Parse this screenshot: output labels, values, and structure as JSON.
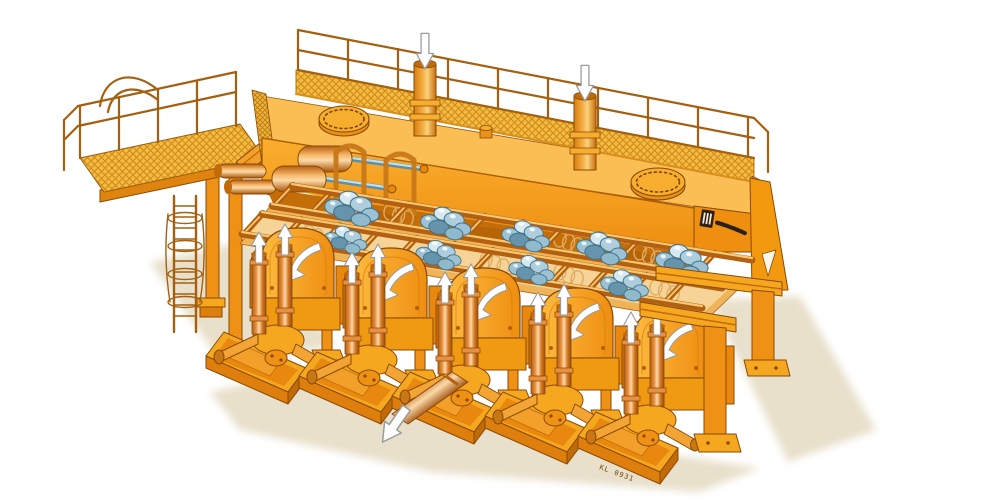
{
  "document": {
    "kind": "technical-illustration",
    "subject": "Isometric airbrush cutaway of an orange industrial machine: tank deck with grated walkway and railings, access platform with caged ladder, reciprocating grate frames carrying blue lump material, and five eccentric drive units on skid bases",
    "background": "#ffffff"
  },
  "texts": {
    "drawing_number": "KL 0931"
  },
  "brand_plate": {
    "legible": false,
    "style": "small dark emblem with slanted italic wordmark on right end panel"
  },
  "palette": {
    "orange_base": "#F49C16",
    "orange_light": "#FBBE55",
    "orange_pale": "#FDD98E",
    "orange_dark": "#DE7E0C",
    "orange_deep": "#C06A08",
    "outline_brown": "#8A4A05",
    "grating_yellow": "#F3BC3F",
    "grating_hatch": "#CE8A1E",
    "railing_brown": "#A4600F",
    "copper_light": "#FCD9A8",
    "copper_mid": "#E89040",
    "copper_dark": "#B55E14",
    "lump_blue_light": "#D7E8F0",
    "lump_blue_mid": "#9CC2D4",
    "lump_blue_dark": "#6594AC",
    "lump_outline": "#41758E",
    "arrow_white": "#FFFFFF",
    "arrow_edge": "#9A9A9A",
    "ground_shadow": "#E8E0CB",
    "trough_tan": "#F6D79E",
    "interior_dark": "#C46E0A"
  },
  "flow_arrows": {
    "inlet_down_arrows": 2,
    "drum_rotation_arrows": 5,
    "piston_up_arrows": 10,
    "discharge_outline_arrows": 1
  },
  "components": {
    "drive_units": 5,
    "manhole_covers": 2,
    "inlet_pipes": 2,
    "hydraulic_cylinders": 2,
    "material_lump_clusters": 9,
    "grate_frames": 2,
    "grate_crossbars_per_frame": 12,
    "table_support_posts": 4,
    "access_platform": 1,
    "ladder_with_safety_cage": 1,
    "right_support_frame_legs": 2,
    "discharge_pipe": 1
  }
}
